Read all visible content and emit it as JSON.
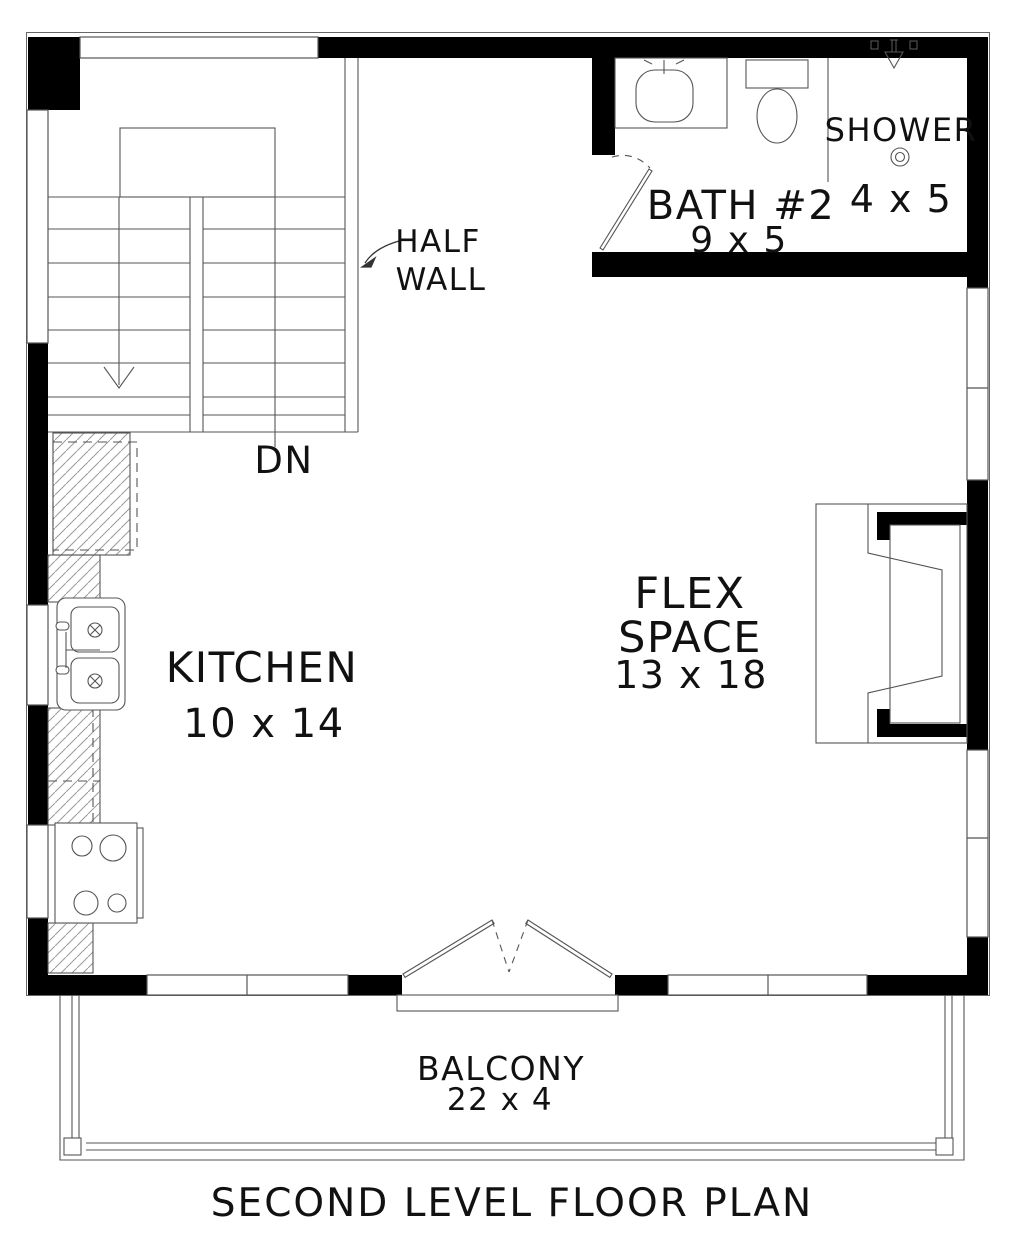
{
  "title": "SECOND LEVEL FLOOR PLAN",
  "rooms": {
    "bath2": {
      "name": "BATH #2",
      "size": "9 x 5"
    },
    "shower": {
      "name": "SHOWER",
      "size": "4 x 5"
    },
    "kitchen": {
      "name": "KITCHEN",
      "size": "10 x 14"
    },
    "flex_space": {
      "line1": "FLEX",
      "line2": "SPACE",
      "size": "13 x 18"
    },
    "balcony": {
      "name": "BALCONY",
      "size": "22 x 4"
    }
  },
  "annotations": {
    "half_wall": {
      "line1": "HALF",
      "line2": "WALL"
    },
    "stair_direction": "DN"
  },
  "fixtures": [
    "stairs-down",
    "refrigerator",
    "kitchen-double-sink",
    "range-cooktop",
    "bathroom-vanity-sink",
    "toilet",
    "shower-head",
    "floor-drain",
    "bay-window-seat",
    "french-doors",
    "balcony-railing"
  ],
  "colors": {
    "wall": "#000000",
    "thin_line": "#555555",
    "hatch": "#9a9a9a",
    "text": "#111111",
    "background": "#ffffff"
  }
}
